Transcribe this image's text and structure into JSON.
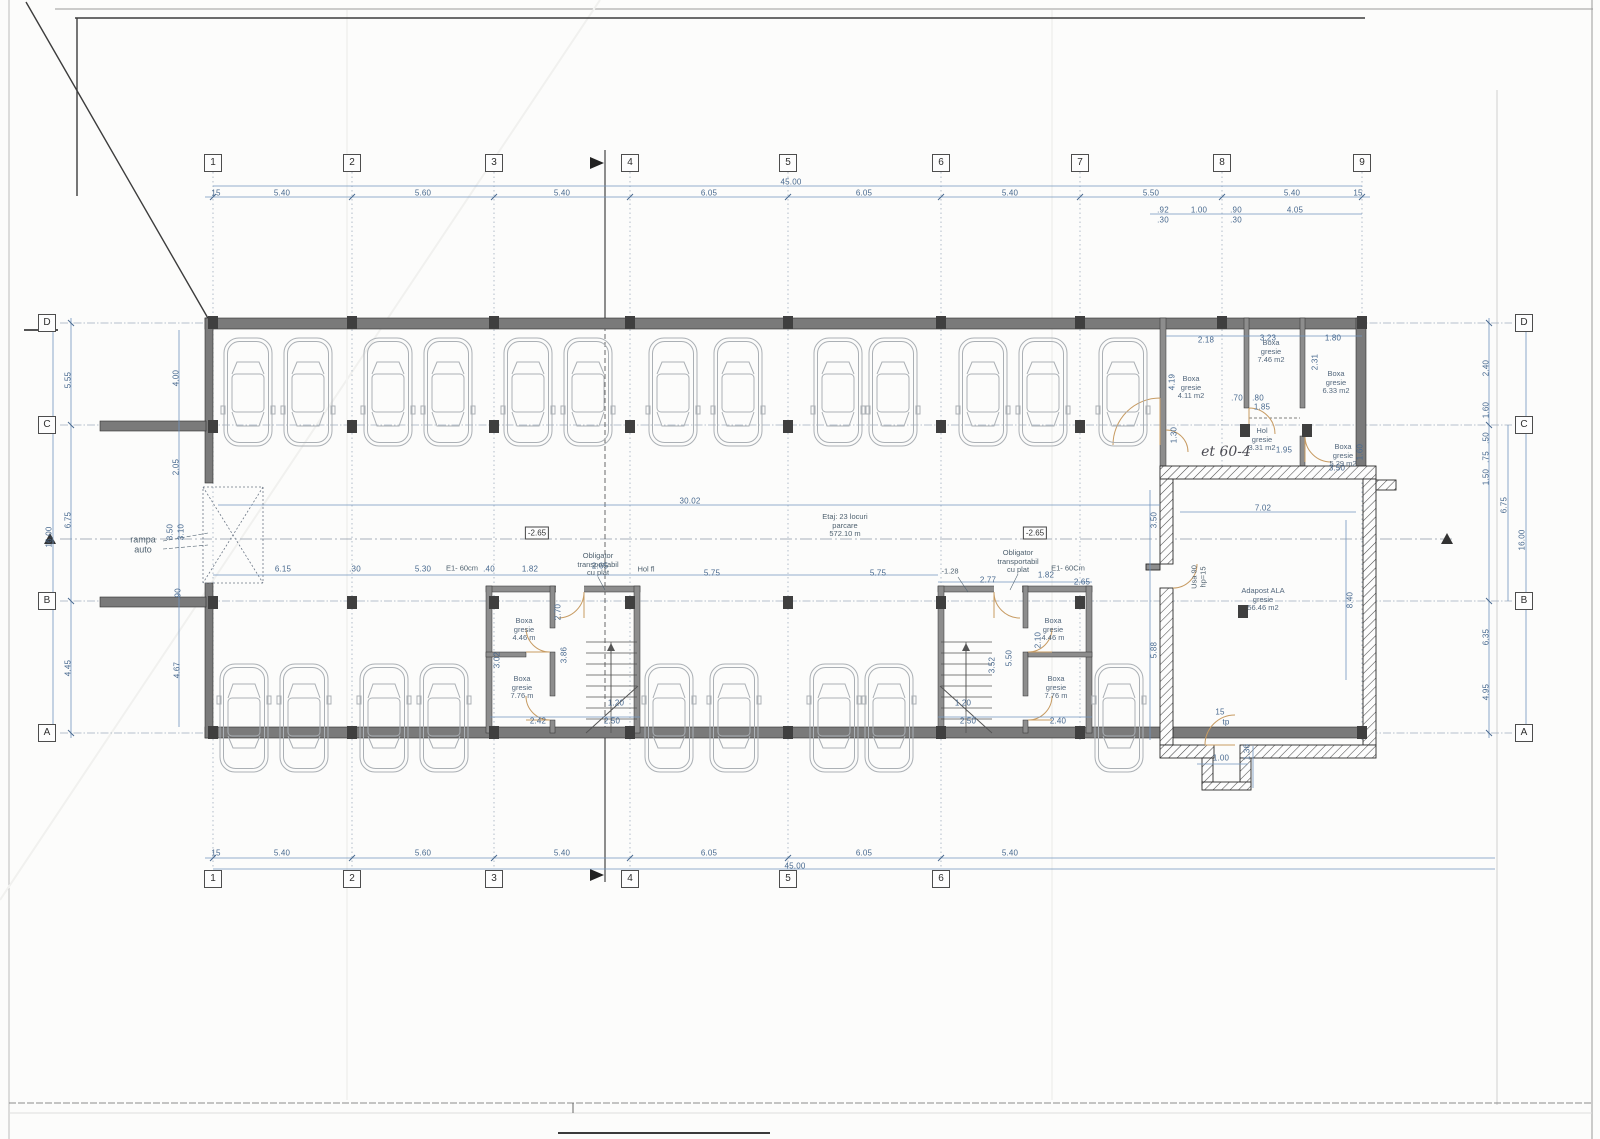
{
  "meta": {
    "drawing_type": "basement parking floor plan",
    "accent_blue": "#48698f",
    "wall_gray": "#7a7a7a",
    "door_tan": "#c79b62"
  },
  "notes": {
    "rampa": "rampa\nauto",
    "center": "Etaj: 23 locuri\nparcare\n572.10 m",
    "obligator": "Obligator\ntransportabil\ncu plat",
    "hand": "et 60-4"
  },
  "bubbles": [
    {
      "t": "1",
      "x": 213,
      "y": 163
    },
    {
      "t": "2",
      "x": 352,
      "y": 163
    },
    {
      "t": "3",
      "x": 494,
      "y": 163
    },
    {
      "t": "4",
      "x": 630,
      "y": 163
    },
    {
      "t": "5",
      "x": 788,
      "y": 163
    },
    {
      "t": "6",
      "x": 941,
      "y": 163
    },
    {
      "t": "7",
      "x": 1080,
      "y": 163
    },
    {
      "t": "8",
      "x": 1222,
      "y": 163
    },
    {
      "t": "9",
      "x": 1362,
      "y": 163
    },
    {
      "t": "1",
      "x": 213,
      "y": 879
    },
    {
      "t": "2",
      "x": 352,
      "y": 879
    },
    {
      "t": "3",
      "x": 494,
      "y": 879
    },
    {
      "t": "4",
      "x": 630,
      "y": 879
    },
    {
      "t": "5",
      "x": 788,
      "y": 879
    },
    {
      "t": "6",
      "x": 941,
      "y": 879
    },
    {
      "t": "D",
      "x": 47,
      "y": 323
    },
    {
      "t": "C",
      "x": 47,
      "y": 425
    },
    {
      "t": "B",
      "x": 47,
      "y": 601
    },
    {
      "t": "A",
      "x": 47,
      "y": 733
    },
    {
      "t": "D",
      "x": 1524,
      "y": 323
    },
    {
      "t": "C",
      "x": 1524,
      "y": 425
    },
    {
      "t": "B",
      "x": 1524,
      "y": 601
    },
    {
      "t": "A",
      "x": 1524,
      "y": 733
    }
  ],
  "dim_labels": [
    {
      "t": "15",
      "x": 216,
      "y": 193
    },
    {
      "t": "5.40",
      "x": 282,
      "y": 193
    },
    {
      "t": "5.60",
      "x": 423,
      "y": 193
    },
    {
      "t": "5.40",
      "x": 562,
      "y": 193
    },
    {
      "t": "6.05",
      "x": 709,
      "y": 193
    },
    {
      "t": "6.05",
      "x": 864,
      "y": 193
    },
    {
      "t": "5.40",
      "x": 1010,
      "y": 193
    },
    {
      "t": "5.50",
      "x": 1151,
      "y": 193
    },
    {
      "t": "5.40",
      "x": 1292,
      "y": 193
    },
    {
      "t": "15",
      "x": 1358,
      "y": 193
    },
    {
      "t": "45.00",
      "x": 791,
      "y": 182
    },
    {
      "t": ".92",
      "x": 1163,
      "y": 210
    },
    {
      "t": "1.00",
      "x": 1199,
      "y": 210
    },
    {
      "t": ".90",
      "x": 1236,
      "y": 210
    },
    {
      "t": "4.05",
      "x": 1295,
      "y": 210
    },
    {
      "t": ".30",
      "x": 1163,
      "y": 220
    },
    {
      "t": ".30",
      "x": 1236,
      "y": 220
    },
    {
      "t": "15",
      "x": 216,
      "y": 853
    },
    {
      "t": "5.40",
      "x": 282,
      "y": 853
    },
    {
      "t": "5.60",
      "x": 423,
      "y": 853
    },
    {
      "t": "5.40",
      "x": 562,
      "y": 853
    },
    {
      "t": "6.05",
      "x": 709,
      "y": 853
    },
    {
      "t": "6.05",
      "x": 864,
      "y": 853
    },
    {
      "t": "5.40",
      "x": 1010,
      "y": 853
    },
    {
      "t": "45.00",
      "x": 795,
      "y": 866
    },
    {
      "t": "16.00",
      "x": 49,
      "y": 537,
      "r": -90
    },
    {
      "t": "5.55",
      "x": 68,
      "y": 380,
      "r": -90
    },
    {
      "t": "6.75",
      "x": 68,
      "y": 520,
      "r": -90
    },
    {
      "t": "4.45",
      "x": 68,
      "y": 668,
      "r": -90
    },
    {
      "t": "4.00",
      "x": 176,
      "y": 378,
      "r": -90
    },
    {
      "t": "2.05",
      "x": 176,
      "y": 467,
      "r": -90
    },
    {
      "t": "3.50",
      "x": 170,
      "y": 532,
      "r": -90
    },
    {
      "t": "3.10",
      "x": 181,
      "y": 532,
      "r": -90
    },
    {
      "t": ".90",
      "x": 178,
      "y": 594,
      "r": -90
    },
    {
      "t": "4.67",
      "x": 177,
      "y": 670,
      "r": -90
    },
    {
      "t": "16.00",
      "x": 1522,
      "y": 540,
      "r": -90
    },
    {
      "t": "6.75",
      "x": 1504,
      "y": 505,
      "r": -90
    },
    {
      "t": "2.40",
      "x": 1486,
      "y": 368,
      "r": -90
    },
    {
      "t": "1.60",
      "x": 1486,
      "y": 410,
      "r": -90
    },
    {
      "t": ".50",
      "x": 1486,
      "y": 438,
      "r": -90
    },
    {
      "t": ".75",
      "x": 1486,
      "y": 457,
      "r": -90
    },
    {
      "t": "1.50",
      "x": 1486,
      "y": 477,
      "r": -90
    },
    {
      "t": "6.35",
      "x": 1486,
      "y": 637,
      "r": -90
    },
    {
      "t": "4.95",
      "x": 1486,
      "y": 692,
      "r": -90
    },
    {
      "t": "6.15",
      "x": 283,
      "y": 569
    },
    {
      "t": ".30",
      "x": 355,
      "y": 569
    },
    {
      "t": "5.30",
      "x": 423,
      "y": 569
    },
    {
      "t": ".40",
      "x": 489,
      "y": 569
    },
    {
      "t": "1.82",
      "x": 530,
      "y": 569
    },
    {
      "t": "2.65",
      "x": 600,
      "y": 566
    },
    {
      "t": "5.75",
      "x": 712,
      "y": 573
    },
    {
      "t": "5.75",
      "x": 878,
      "y": 573
    },
    {
      "t": "2.77",
      "x": 988,
      "y": 580
    },
    {
      "t": "1.82",
      "x": 1046,
      "y": 575
    },
    {
      "t": "2.65",
      "x": 1082,
      "y": 582
    },
    {
      "t": "2.42",
      "x": 538,
      "y": 721
    },
    {
      "t": "2.50",
      "x": 612,
      "y": 721
    },
    {
      "t": "1.20",
      "x": 616,
      "y": 703
    },
    {
      "t": "3.02",
      "x": 497,
      "y": 660,
      "r": -90
    },
    {
      "t": "3.86",
      "x": 564,
      "y": 655,
      "r": -90
    },
    {
      "t": "2.70",
      "x": 558,
      "y": 612,
      "r": -90
    },
    {
      "t": "1.20",
      "x": 963,
      "y": 703
    },
    {
      "t": "2.50",
      "x": 968,
      "y": 721
    },
    {
      "t": "2.40",
      "x": 1058,
      "y": 721
    },
    {
      "t": "5.50",
      "x": 1009,
      "y": 658,
      "r": -90
    },
    {
      "t": "3.52",
      "x": 992,
      "y": 665,
      "r": -90
    },
    {
      "t": "2.10",
      "x": 1038,
      "y": 640,
      "r": -90
    },
    {
      "t": "2.18",
      "x": 1206,
      "y": 340
    },
    {
      "t": "3.23",
      "x": 1268,
      "y": 338
    },
    {
      "t": "1.80",
      "x": 1333,
      "y": 338
    },
    {
      "t": "2.31",
      "x": 1315,
      "y": 362,
      "r": -90
    },
    {
      "t": "4.19",
      "x": 1172,
      "y": 382,
      "r": -90
    },
    {
      "t": ".70",
      "x": 1237,
      "y": 398
    },
    {
      "t": ".80",
      "x": 1258,
      "y": 398
    },
    {
      "t": "1.85",
      "x": 1262,
      "y": 407
    },
    {
      "t": "1.95",
      "x": 1284,
      "y": 450
    },
    {
      "t": "3.50",
      "x": 1337,
      "y": 468
    },
    {
      "t": "1.60",
      "x": 1360,
      "y": 452,
      "r": -90
    },
    {
      "t": "1.30",
      "x": 1174,
      "y": 435,
      "r": -90
    },
    {
      "t": "30.02",
      "x": 690,
      "y": 501
    },
    {
      "t": "7.02",
      "x": 1263,
      "y": 508
    },
    {
      "t": "8.40",
      "x": 1350,
      "y": 600,
      "r": -90
    },
    {
      "t": "3.50",
      "x": 1154,
      "y": 520,
      "r": -90
    },
    {
      "t": "5.88",
      "x": 1154,
      "y": 650,
      "r": -90
    },
    {
      "t": "1.00",
      "x": 1221,
      "y": 758
    },
    {
      "t": "1.36",
      "x": 1247,
      "y": 752,
      "r": -90
    },
    {
      "t": "15",
      "x": 1220,
      "y": 712
    },
    {
      "t": "tp",
      "x": 1226,
      "y": 722
    }
  ],
  "small_notes": [
    {
      "t": "E1- 60cm",
      "x": 462,
      "y": 569
    },
    {
      "t": "Hol fl",
      "x": 646,
      "y": 570
    },
    {
      "t": "E1- 60Cm",
      "x": 1068,
      "y": 569
    },
    {
      "t": "-1.28",
      "x": 950,
      "y": 572
    },
    {
      "t": "Usa 90\nhp=15",
      "x": 1199,
      "y": 577,
      "r": -90
    }
  ],
  "room_labels": [
    {
      "t": "Boxa\ngresie\n4.11 m2",
      "x": 1191,
      "y": 388
    },
    {
      "t": "Boxa\ngresie\n7.46 m2",
      "x": 1271,
      "y": 352
    },
    {
      "t": "Boxa\ngresie\n6.33 m2",
      "x": 1336,
      "y": 383
    },
    {
      "t": "Hol\ngresie\n3.31 m2",
      "x": 1262,
      "y": 440
    },
    {
      "t": "Boxa\ngresie\n5.29 m2",
      "x": 1343,
      "y": 456
    },
    {
      "t": "Boxa\ngresie\n4.46 m",
      "x": 524,
      "y": 630
    },
    {
      "t": "Boxa\ngresie\n7.76 m",
      "x": 522,
      "y": 688
    },
    {
      "t": "Boxa\ngresie\n4.46 m",
      "x": 1053,
      "y": 630
    },
    {
      "t": "Boxa\ngresie\n7.76 m",
      "x": 1056,
      "y": 688
    },
    {
      "t": "Adapost ALA\ngresie\n56.46 m2",
      "x": 1263,
      "y": 600
    }
  ],
  "elevation_marks": [
    {
      "t": "-2.65",
      "x": 537,
      "y": 533
    },
    {
      "t": "-2.65",
      "x": 1035,
      "y": 533
    }
  ]
}
